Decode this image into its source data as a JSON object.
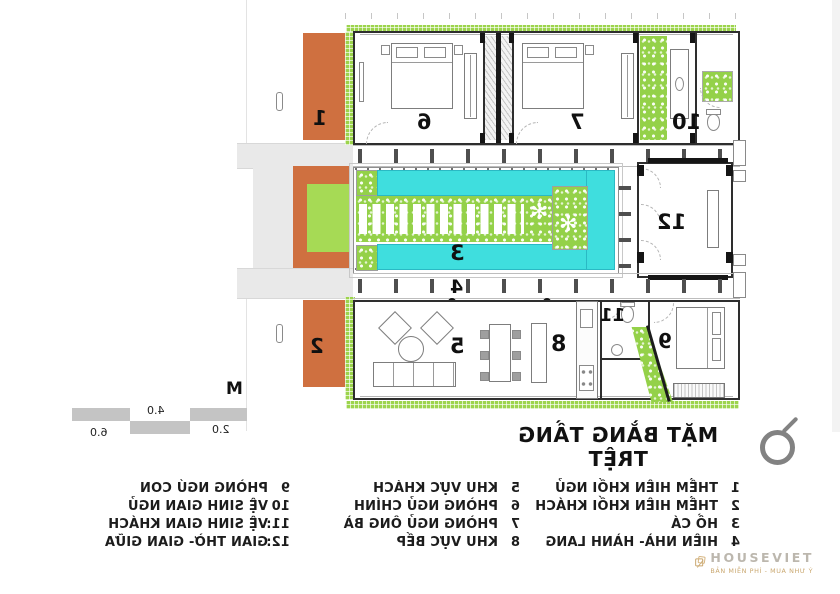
{
  "title": "MẶT BẰNG TẦNG TRỆT",
  "rooms": {
    "n1": "1",
    "n2": "2",
    "n3": "3",
    "n4": "4",
    "n5": "5",
    "n6": "6",
    "n7": "7",
    "n8": "8",
    "n9": "9",
    "n10": "10",
    "n11": "11",
    "n12": "12"
  },
  "scale_bar": {
    "unit": "M",
    "marks": [
      "2.0",
      "4.0",
      "6.0"
    ]
  },
  "legend": {
    "col1": {
      "items": [
        {
          "num": "1",
          "label": "THỀM HIÊN KHỐI NGỦ"
        },
        {
          "num": "2",
          "label": "THỀM HIÊN KHỐI KHÁCH"
        },
        {
          "num": "3",
          "label": "HỒ CÁ"
        },
        {
          "num": "4",
          "label": "HIÊN NHÀ- HÀNH LANG"
        }
      ]
    },
    "col2": {
      "items": [
        {
          "num": "5",
          "label": "KHU VỰC KHÁCH"
        },
        {
          "num": "6",
          "label": "PHÒNG NGỦ CHÍNH"
        },
        {
          "num": "7",
          "label": "PHÒNG NGỦ ÔNG BÀ"
        },
        {
          "num": "8",
          "label": "KHU VỰC BẾP"
        }
      ]
    },
    "col3": {
      "items": [
        {
          "num": "9",
          "label": "PHÒNG NGỦ CON"
        },
        {
          "num": "10",
          "label": "VỆ SINH GIAN NGỦ"
        },
        {
          "num": "11:",
          "label": "VỆ SINH GIAN KHÁCH"
        },
        {
          "num": "12:",
          "label": "GIAN THỜ- GIAN GIỮA"
        }
      ]
    }
  },
  "watermark": {
    "brand": "HOUSEVIET",
    "tagline": "BẢN MIỄN PHÍ - MUA NHƯ Ý"
  },
  "colors": {
    "accent_orange": "#cf7040",
    "accent_lime": "#9bd54c",
    "pool_cyan": "#3fdede",
    "path_gray": "#e9e9e9",
    "scale_gray": "#c4c4c4",
    "watermark_gold": "#c7a368"
  }
}
